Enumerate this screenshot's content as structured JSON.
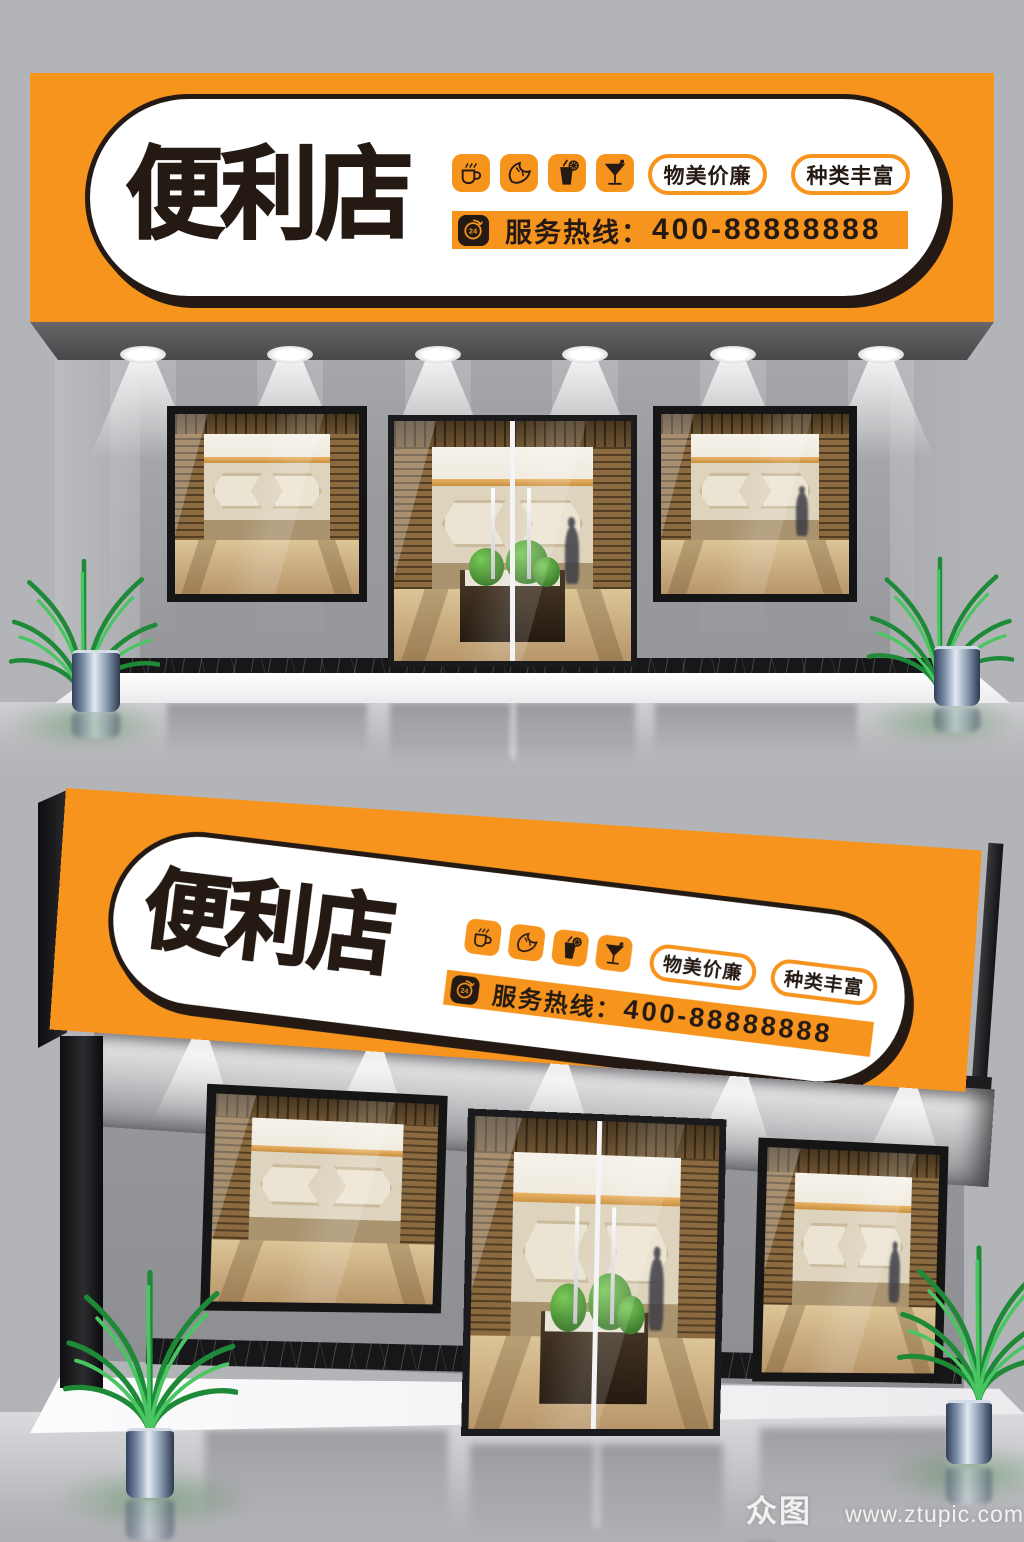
{
  "sign": {
    "title": "便利店",
    "badges": [
      {
        "label": "物美价廉"
      },
      {
        "label": "种类丰富"
      }
    ],
    "hotline": {
      "label": "服务热线：",
      "number": "400-88888888",
      "badge": "24"
    },
    "icons": [
      {
        "name": "coffee-icon"
      },
      {
        "name": "croissant-icon"
      },
      {
        "name": "soda-glass-icon"
      },
      {
        "name": "cocktail-icon"
      }
    ],
    "colors": {
      "orange": "#F7941E",
      "ink": "#241A13",
      "panel_white": "#FFFFFF"
    }
  },
  "watermark": {
    "logo": "众图网",
    "url": "www.ztupic.com"
  }
}
